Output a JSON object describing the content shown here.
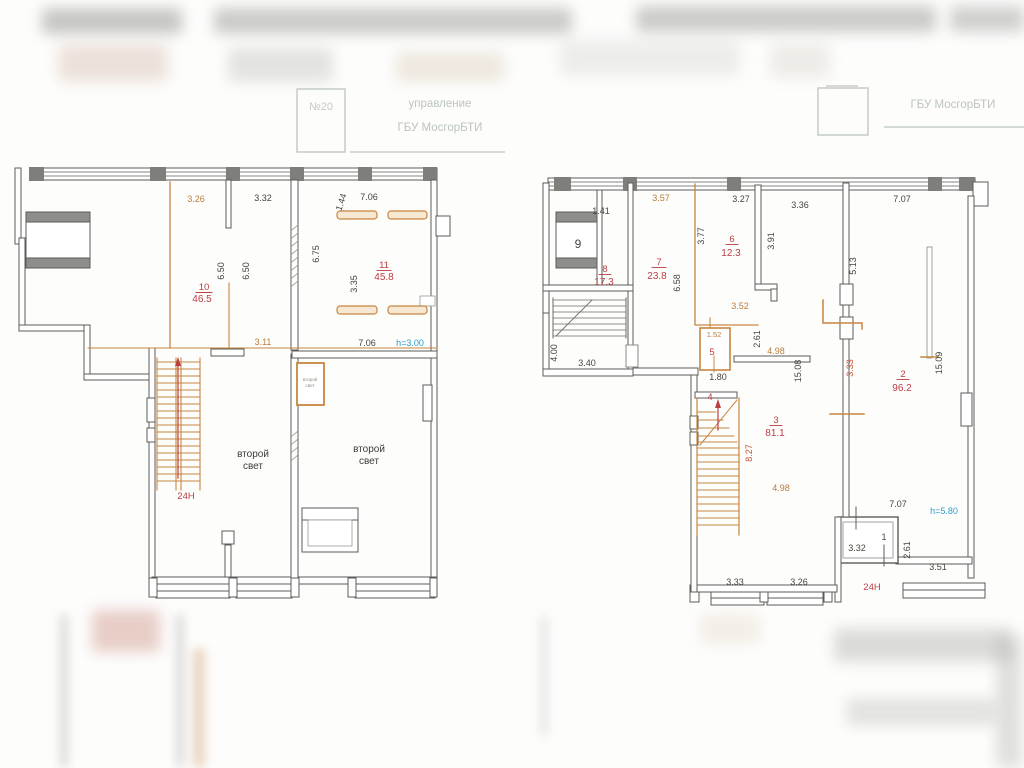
{
  "stamps": {
    "left": {
      "number": "№20",
      "line1": "управление",
      "line2": "ГБУ МосгорБТИ"
    },
    "right": {
      "line1": "ГБУ МосгорБТИ"
    }
  },
  "left_plan": {
    "rooms": {
      "r10": {
        "number": "10",
        "area": "46.5"
      },
      "r11": {
        "number": "11",
        "area": "45.8"
      }
    },
    "labels": {
      "height": "h=3.00",
      "stair": "24H",
      "second_light_a": {
        "line1": "второй",
        "line2": "свет"
      },
      "second_light_b": {
        "line1": "второй",
        "line2": "свет"
      },
      "second_light_small": {
        "line1": "второй",
        "line2": "свет"
      }
    },
    "dims": {
      "w_326": "3.26",
      "w_332": "3.32",
      "w_144": "1.44",
      "w_706_top": "7.06",
      "h_650_a": "6.50",
      "h_650_b": "6.50",
      "h_675": "6.75",
      "h_335": "3.35",
      "w_311": "3.11",
      "w_706_bottom": "7.06"
    }
  },
  "right_plan": {
    "rooms": {
      "r9": {
        "number": "9"
      },
      "r8": {
        "number": "8",
        "area": "17.3"
      },
      "r7": {
        "number": "7",
        "area": "23.8"
      },
      "r6": {
        "number": "6",
        "area": "12.3"
      },
      "r5": {
        "number": "5"
      },
      "r4": {
        "number": "4"
      },
      "r3": {
        "number": "3",
        "area": "81.1"
      },
      "r2": {
        "number": "2",
        "area": "96.2"
      },
      "r1": {
        "number": "1"
      }
    },
    "labels": {
      "height": "h=5.80",
      "stair": "24H"
    },
    "dims": {
      "w_141": "1.41",
      "w_357": "3.57",
      "w_327": "3.27",
      "w_336": "3.36",
      "w_707_top": "7.07",
      "h_377": "3.77",
      "h_391": "3.91",
      "h_658": "6.58",
      "h_513": "5.13",
      "w_352": "3.52",
      "h_261_a": "2.61",
      "w_152": "1.52",
      "w_498_a": "4.98",
      "h_1508": "15.08",
      "w_180": "1.80",
      "h_827": "8.27",
      "w_498_b": "4.98",
      "h_333": "3.33",
      "h_1509": "15.09",
      "w_707_bottom": "7.07",
      "w_332": "3.32",
      "h_261_b": "2.61",
      "w_351": "3.51",
      "w_333_bottom": "3.33",
      "w_326_bottom": "3.26",
      "h_400": "4.00",
      "w_340": "3.40"
    }
  },
  "colors": {
    "wall": "#5c5c58",
    "dim_dark": "#44443f",
    "dim_orange": "#b97c3a",
    "room_red": "#bb3e44",
    "stair_orange": "#c8853f",
    "height_blue": "#2d9fd0",
    "stamp": "#bcc5bd",
    "paper": "#fdfdfc"
  }
}
